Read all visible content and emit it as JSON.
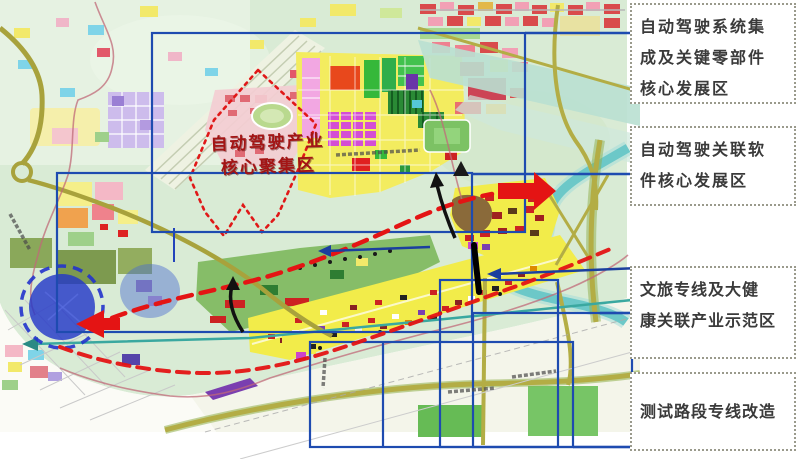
{
  "map": {
    "core_zone_label": {
      "lines": [
        "自动驾驶产业",
        "核心聚集区"
      ]
    }
  },
  "callouts": [
    {
      "id": 1,
      "lines": [
        "自动驾驶系统集",
        "成及关键零部件",
        "核心发展区"
      ]
    },
    {
      "id": 2,
      "lines": [
        "自动驾驶关联软",
        "件核心发展区"
      ]
    },
    {
      "id": 3,
      "lines": [
        "文旅专线及大健",
        "康关联产业示范区"
      ]
    },
    {
      "id": 4,
      "lines": [
        "测试路段专线改造"
      ]
    }
  ],
  "colors": {
    "callout_border": "#9a9a8c",
    "callout_text": "#3a3a3a",
    "focus_rect_blue": "#1e4bb0",
    "route_red": "#e41414",
    "map_label_red": "#a31515",
    "river_teal": "#6cc8c8",
    "road_olive": "#a8a23c",
    "circle_blue": "#2438c8",
    "map_green": "#d9ebd5",
    "parcel_yellow": "#f3ec5f"
  }
}
